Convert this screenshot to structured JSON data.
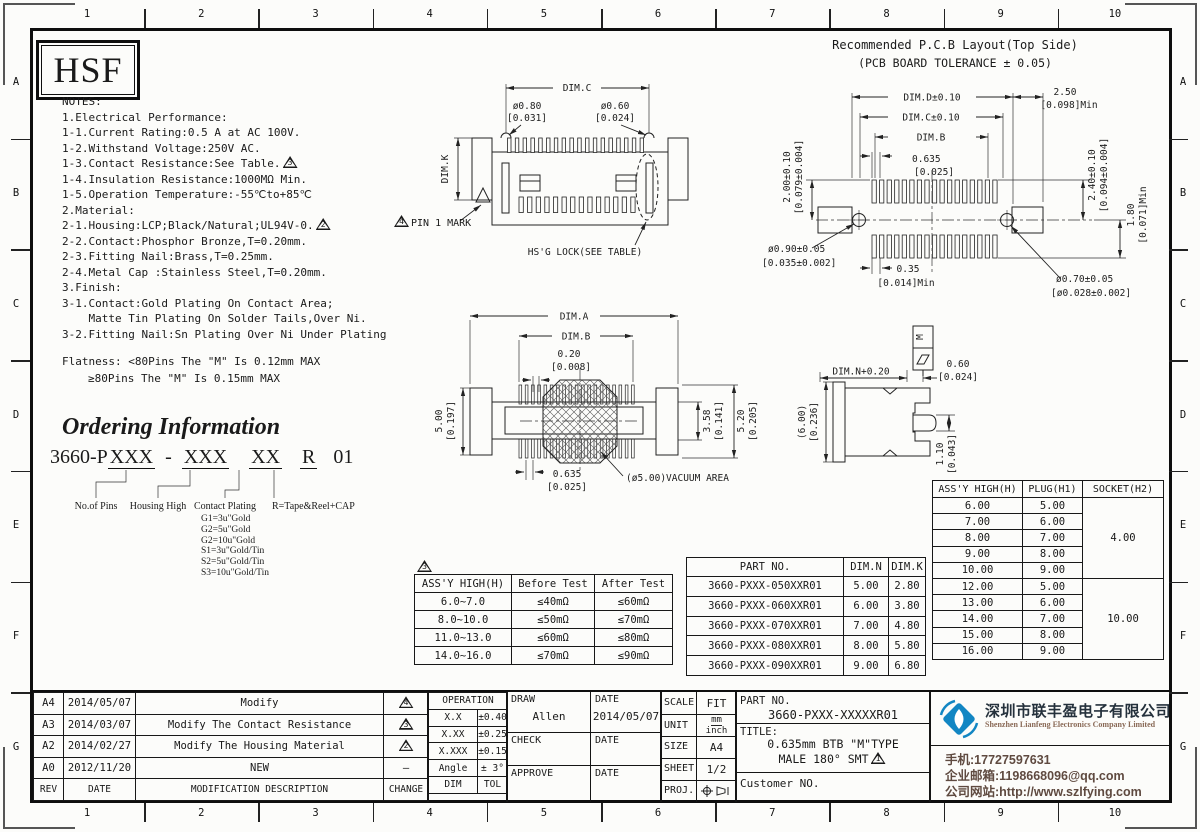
{
  "frame": {
    "columns": [
      "1",
      "2",
      "3",
      "4",
      "5",
      "6",
      "7",
      "8",
      "9",
      "10"
    ],
    "rows": [
      "A",
      "B",
      "C",
      "D",
      "E",
      "F",
      "G"
    ]
  },
  "logo_box": {
    "text": "HSF"
  },
  "notes": {
    "lines": [
      {
        "text": "NOTES:"
      },
      {
        "text": "1.Electrical Performance:"
      },
      {
        "text": "1-1.Current Rating:0.5 A at AC 100V."
      },
      {
        "text": "1-2.Withstand Voltage:250V AC."
      },
      {
        "text": "1-3.Contact Resistance:See Table.",
        "flag": "3"
      },
      {
        "text": "1-4.Insulation Resistance:1000MΩ Min."
      },
      {
        "text": "1-5.Operation Temperature:-55℃to+85℃"
      },
      {
        "text": "2.Material:"
      },
      {
        "text": "2-1.Housing:LCP;Black/Natural;UL94V-0.",
        "flag": "2"
      },
      {
        "text": "2-2.Contact:Phosphor Bronze,T=0.20mm."
      },
      {
        "text": "2-3.Fitting Nail:Brass,T=0.25mm."
      },
      {
        "text": "2-4.Metal Cap :Stainless Steel,T=0.20mm."
      },
      {
        "text": "3.Finish:"
      },
      {
        "text": "3-1.Contact:Gold Plating On Contact Area;"
      },
      {
        "text": "    Matte Tin Plating On Solder Tails,Over Ni."
      },
      {
        "text": "3-2.Fitting Nail:Sn Plating Over Ni Under Plating"
      }
    ],
    "flatness_line1": "Flatness: <80Pins The \"M\" Is 0.12mm MAX",
    "flatness_line2": "≥80Pins The \"M\" Is 0.15mm MAX"
  },
  "ordering": {
    "title": "Ordering Information",
    "part_segments": [
      {
        "t": "3660-P",
        "u": false,
        "m": 0
      },
      {
        "t": "XXX",
        "u": true,
        "m": 0
      },
      {
        "t": "-",
        "u": false,
        "m": 10
      },
      {
        "t": "XXX",
        "u": true,
        "m": 10
      },
      {
        "t": "XX",
        "u": true,
        "m": 20
      },
      {
        "t": "R",
        "u": true,
        "m": 18
      },
      {
        "t": "01",
        "u": false,
        "m": 16
      }
    ],
    "labels": [
      "No.of Pins",
      "Housing High",
      "Contact Plating",
      "R=Tape&Reel+CAP"
    ],
    "plating_options": [
      "G1=3u\"Gold",
      "G2=5u\"Gold",
      "G2=10u\"Gold",
      "S1=3u\"Gold/Tin",
      "S2=5u\"Gold/Tin",
      "S3=10u\"Gold/Tin"
    ]
  },
  "front_view": {
    "dim_c": "DIM.C",
    "d080": "ø0.80",
    "d080_in": "[0.031]",
    "d060": "ø0.60",
    "d060_in": "[0.024]",
    "dim_k": "DIM.K",
    "pin1_flag": "4",
    "pin1": "PIN 1 MARK",
    "lock": "HS'G LOCK(SEE TABLE)"
  },
  "top_view": {
    "dim_a": "DIM.A",
    "dim_b": "DIM.B",
    "d020": "0.20",
    "d020_in": "[0.008]",
    "h500": "5.00",
    "h500_in": "[0.197]",
    "h358": "3.58",
    "h358_in": "[0.141]",
    "h520": "5.20",
    "h520_in": "[0.205]",
    "pitch": "0.635",
    "pitch_in": "[0.025]",
    "vacuum": "(ø5.00)VACUUM AREA"
  },
  "side_view": {
    "dim_n": "DIM.N+0.20",
    "d060": "0.60",
    "d060_in": "[0.024]",
    "h600": "(6.00)",
    "h600_in": "[0.236]",
    "h110": "1.10",
    "h110_in": "[0.043]",
    "flag_m": "M"
  },
  "pcb": {
    "title1": "Recommended P.C.B Layout(Top Side)",
    "title2": "(PCB BOARD TOLERANCE ± 0.05)",
    "dim_d": "DIM.D±0.10",
    "dim_c": "DIM.C±0.10",
    "dim_b": "DIM.B",
    "pitch": "0.635",
    "pitch_in": "[0.025]",
    "m250": "2.50",
    "m250_in": "[0.098]Min",
    "l200": "2.00±0.10",
    "l200_in": "[0.079±0.004]",
    "r240": "2.40±0.10",
    "r240_in": "[0.094±0.004]",
    "r180": "1.80",
    "r180_in": "[0.071]Min",
    "h090": "ø0.90±0.05",
    "h090_in": "[0.035±0.002]",
    "p035": "0.35",
    "p035_in": "[0.014]Min",
    "h070": "ø0.70±0.05",
    "h070_in": "[ø0.028±0.002]"
  },
  "contact_table": {
    "flag": "3",
    "headers": [
      "ASS'Y HIGH(H)",
      "Before Test",
      "After Test"
    ],
    "rows": [
      [
        "6.0~7.0",
        "≤40mΩ",
        "≤60mΩ"
      ],
      [
        "8.0~10.0",
        "≤50mΩ",
        "≤70mΩ"
      ],
      [
        "11.0~13.0",
        "≤60mΩ",
        "≤80mΩ"
      ],
      [
        "14.0~16.0",
        "≤70mΩ",
        "≤90mΩ"
      ]
    ]
  },
  "part_table": {
    "headers": [
      "PART NO.",
      "DIM.N",
      "DIM.K"
    ],
    "rows": [
      [
        "3660-PXXX-050XXR01",
        "5.00",
        "2.80"
      ],
      [
        "3660-PXXX-060XXR01",
        "6.00",
        "3.80"
      ],
      [
        "3660-PXXX-070XXR01",
        "7.00",
        "4.80"
      ],
      [
        "3660-PXXX-080XXR01",
        "8.00",
        "5.80"
      ],
      [
        "3660-PXXX-090XXR01",
        "9.00",
        "6.80"
      ]
    ]
  },
  "height_table": {
    "headers": [
      "ASS'Y HIGH(H)",
      "PLUG(H1)",
      "SOCKET(H2)"
    ],
    "group1": {
      "rows": [
        [
          "6.00",
          "5.00"
        ],
        [
          "7.00",
          "6.00"
        ],
        [
          "8.00",
          "7.00"
        ],
        [
          "9.00",
          "8.00"
        ],
        [
          "10.00",
          "9.00"
        ]
      ],
      "socket": "4.00"
    },
    "group2": {
      "rows": [
        [
          "12.00",
          "5.00"
        ],
        [
          "13.00",
          "6.00"
        ],
        [
          "14.00",
          "7.00"
        ],
        [
          "15.00",
          "8.00"
        ],
        [
          "16.00",
          "9.00"
        ]
      ],
      "socket": "10.00"
    }
  },
  "revision_table": {
    "rows": [
      {
        "rev": "A4",
        "date": "2014/05/07",
        "desc": "Modify",
        "flag": "4"
      },
      {
        "rev": "A3",
        "date": "2014/03/07",
        "desc": "Modify The Contact Resistance",
        "flag": "3"
      },
      {
        "rev": "A2",
        "date": "2014/02/27",
        "desc": "Modify The Housing Material",
        "flag": "2"
      },
      {
        "rev": "A0",
        "date": "2012/11/20",
        "desc": "NEW",
        "flag": "-"
      }
    ],
    "footer": [
      "REV",
      "DATE",
      "MODIFICATION DESCRIPTION",
      "CHANGE"
    ]
  },
  "tolerance": {
    "title": "OPERATION",
    "rows": [
      [
        "X.X",
        "±0.40"
      ],
      [
        "X.XX",
        "±0.25"
      ],
      [
        "X.XXX",
        "±0.15"
      ],
      [
        "Angle",
        "± 3°"
      ]
    ],
    "footer": [
      "DIM",
      "TOL"
    ]
  },
  "signoff": {
    "draw": "DRAW",
    "draw_name": "Allen",
    "date": "DATE",
    "draw_date": "2014/05/07",
    "check": "CHECK",
    "approve": "APPROVE"
  },
  "info": {
    "scale_label": "SCALE",
    "scale": "FIT",
    "unit_label": "UNIT",
    "unit_top": "mm",
    "unit_bottom": "inch",
    "size_label": "SIZE",
    "size": "A4",
    "sheet_label": "SHEET",
    "sheet": "1/2",
    "proj_label": "PROJ."
  },
  "title_block": {
    "part_no_label": "PART NO.",
    "part_no": "3660-PXXX-XXXXXR01",
    "title_label": "TITLE:",
    "title_line1": "0.635mm BTB \"M\"TYPE",
    "title_line2": "MALE 180° SMT",
    "title_flag": "1",
    "customer_label": "Customer NO."
  },
  "company": {
    "name_cn": "深圳市联丰盈电子有限公司",
    "name_en": "Shenzhen Lianfeng Electronics Company Limited",
    "lines": [
      "手机:17727597631",
      "企业邮箱:1198668096@qq.com",
      "公司网站:http://www.szlfying.com"
    ]
  },
  "colors": {
    "logo_blue": "#1286c3",
    "line": "#1a1a1a",
    "contact_text": "#5f4a40"
  }
}
